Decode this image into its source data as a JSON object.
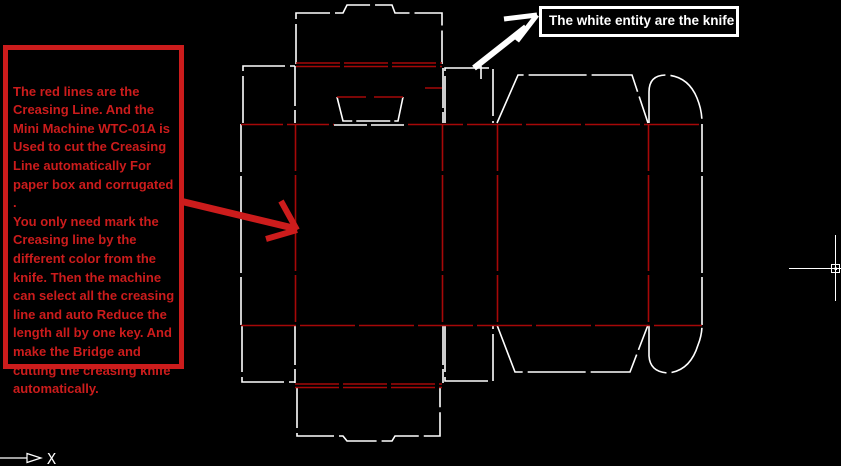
{
  "colors": {
    "background": "#000000",
    "knife": "#ffffff",
    "crease": "#a60808",
    "annotation_red": "#cc1c1c",
    "annotation_white": "#ffffff"
  },
  "notes": {
    "creasing": {
      "text": "The red lines are the\nCreasing Line.  And the\nMini Machine WTC-01A is\nUsed to cut the Creasing\nLine automatically For\npaper box and corrugated .\nYou only need mark the\nCreasing line by the\ndifferent color from the\nknife. Then the machine\ncan select all the creasing\nline and auto Reduce the\nlength  all by one key. And\nmake the Bridge and\ncutting the creasing knife\nautomatically."
    },
    "knife": {
      "text": "The white entity are the knife"
    }
  },
  "ucs": {
    "x_label": "X"
  },
  "cursor": {
    "type": "crosshair-with-pickbox"
  }
}
